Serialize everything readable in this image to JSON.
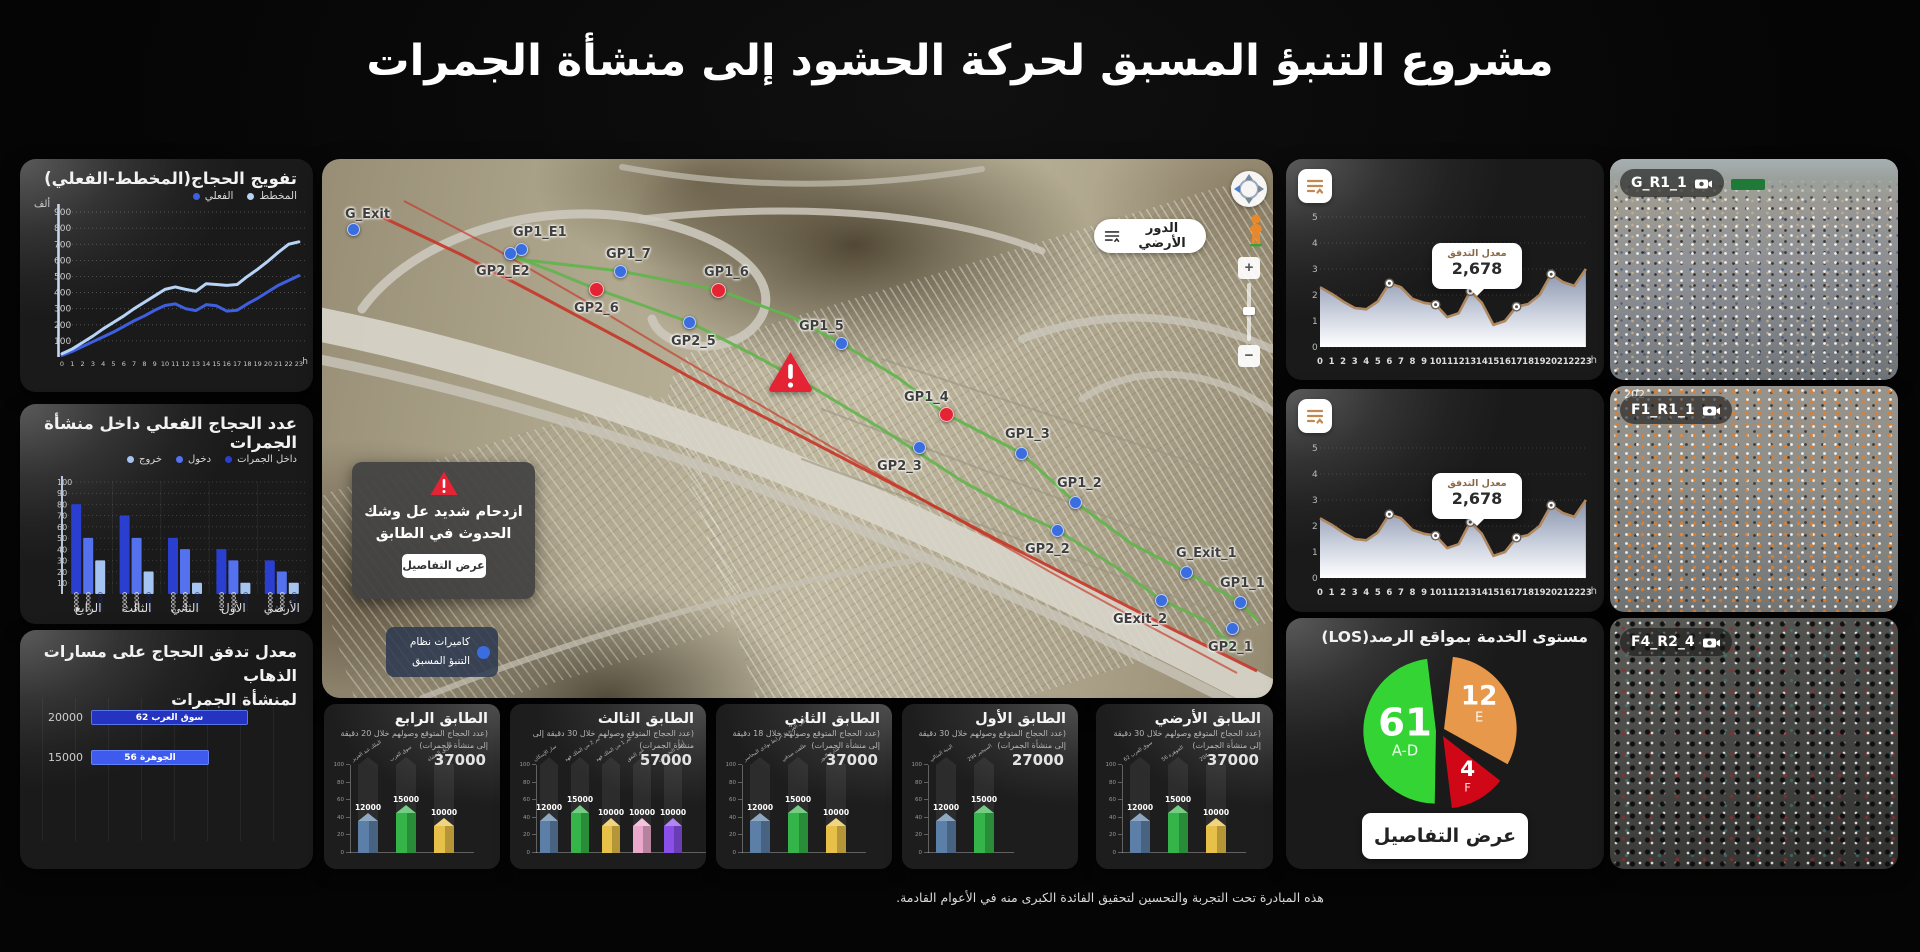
{
  "page": {
    "title": "مشروع التنبؤ المسبق لحركة الحشود إلى منشأة الجمرات",
    "footer": "هذه المبادرة تحت التجربة والتحسين لتحقيق الفائدة الكبرى منه في الأعوام القادمة."
  },
  "chart_data": [
    {
      "id": "tafweej",
      "type": "line",
      "title": "تفويج الحجاج(المخطط-الفعلي)",
      "unit_label": "ألف",
      "x_unit": "h",
      "x": [
        0,
        1,
        2,
        3,
        4,
        5,
        6,
        7,
        8,
        9,
        10,
        11,
        12,
        13,
        14,
        15,
        16,
        17,
        18,
        19,
        20,
        21,
        22,
        23
      ],
      "ylim": [
        0,
        950
      ],
      "yticks": [
        100,
        200,
        300,
        400,
        500,
        600,
        700,
        800,
        900
      ],
      "series": [
        {
          "name": "المخطط",
          "color": "#b7d3f5",
          "values": [
            20,
            50,
            90,
            130,
            175,
            215,
            255,
            300,
            340,
            380,
            420,
            435,
            420,
            408,
            455,
            450,
            445,
            450,
            500,
            545,
            595,
            650,
            700,
            715
          ]
        },
        {
          "name": "الفعلي",
          "color": "#3d5fe0",
          "values": [
            10,
            35,
            65,
            95,
            125,
            155,
            190,
            225,
            255,
            290,
            320,
            330,
            300,
            288,
            325,
            318,
            285,
            290,
            330,
            365,
            405,
            445,
            475,
            505
          ]
        }
      ]
    },
    {
      "id": "inside",
      "type": "bar",
      "title": "عدد الحجاج الفعلي داخل منشأة الجمرات",
      "categories": [
        "الرابع",
        "الثالث",
        "الثاني",
        "الأول",
        "الأرضي"
      ],
      "ylim": [
        0,
        100
      ],
      "yticks": [
        10,
        20,
        30,
        40,
        50,
        60,
        70,
        80,
        90,
        100
      ],
      "unit_scale": 1000,
      "series": [
        {
          "name": "داخل الجمرات",
          "color": "#2a3fd0",
          "values": [
            80000,
            70000,
            50000,
            40000,
            30000
          ]
        },
        {
          "name": "دخول",
          "color": "#5472f0",
          "values": [
            50000,
            50000,
            40000,
            30000,
            20000
          ]
        },
        {
          "name": "خروج",
          "color": "#a6c4f2",
          "values": [
            30000,
            20000,
            10000,
            10000,
            10000
          ]
        }
      ]
    },
    {
      "id": "flow_paths",
      "type": "bar-horizontal",
      "title_line1": "معدل تدفق الحجاج على مسارات الذهاب",
      "title_line2": "لمنشأة الجمرات",
      "xmax": 24000,
      "bars": [
        {
          "label": "سوق العرب 62",
          "value": 20000,
          "value_text": "20000",
          "color": "#2434c0"
        },
        {
          "label": "الجوهرة 56",
          "value": 15000,
          "value_text": "15000",
          "color": "#3f5bee"
        }
      ]
    },
    {
      "id": "floors",
      "type": "bar-group",
      "ylim": [
        0,
        100
      ],
      "yticks": [
        0,
        20,
        40,
        60,
        80,
        100
      ],
      "panels": [
        {
          "title": "الطابق الرابع",
          "subtitle": "(عدد الحجاج المتوقع وصولهم خلال 20 دقيقة إلى منشأة الجمرات)",
          "total": "37000",
          "bars": [
            {
              "label": "الملك عبد العزيز",
              "value": 12000,
              "color": "#5b7fa6"
            },
            {
              "label": "سوق العرب",
              "value": 15000,
              "color": "#35b44a"
            },
            {
              "label": "طريق المشاة",
              "value": 10000,
              "color": "#e7c04a"
            }
          ]
        },
        {
          "title": "الطابق الثالث",
          "subtitle": "(عدد الحجاج المتوقع وصولهم خلال 30 دقيقة إلى منشأة الجمرات)",
          "total": "57000",
          "bars": [
            {
              "label": "سار الإسكان",
              "value": 12000,
              "color": "#5b7fa6"
            },
            {
              "label": "بير 2 من الملك فهد",
              "value": 15000,
              "color": "#35b44a"
            },
            {
              "label": "بير 1 من الملك فهد",
              "value": 10000,
              "color": "#e7c04a"
            },
            {
              "label": "عبر النفق",
              "value": 10000,
              "color": "#eaa8cc"
            },
            {
              "label": "أعلى التخصيص",
              "value": 10000,
              "color": "#8a4fe8"
            }
          ]
        },
        {
          "title": "الطابق الثاني",
          "subtitle": "(عدد الحجاج المتوقع وصولهم خلال 18 دقيقة إلى منشأة الجمرات)",
          "total": "37000",
          "bars": [
            {
              "label": "أعلى العزيزية الرابط بوادي المحاسر",
              "value": 12000,
              "color": "#5b7fa6"
            },
            {
              "label": "طلعت صدقي",
              "value": 15000,
              "color": "#35b44a"
            },
            {
              "label": "شارع النور",
              "value": 10000,
              "color": "#e7c04a"
            }
          ]
        },
        {
          "title": "الطابق الأول",
          "subtitle": "(عدد الحجاج المتوقع وصولهم خلال 30 دقيقة إلى منشأة الجمرات)",
          "total": "27000",
          "bars": [
            {
              "label": "البنية المثالي",
              "value": 12000,
              "color": "#5b7fa6"
            },
            {
              "label": "السيجير 294",
              "value": 15000,
              "color": "#35b44a"
            }
          ]
        },
        {
          "title": "الطابق الأرضي",
          "subtitle": "(عدد الحجاج المتوقع وصولهم خلال 30 دقيقة إلى منشأة الجمرات)",
          "total": "37000",
          "bars": [
            {
              "label": "سوق العرب 62",
              "value": 12000,
              "color": "#5b7fa6"
            },
            {
              "label": "الجوهرة 56",
              "value": 15000,
              "color": "#35b44a"
            },
            {
              "label": "204",
              "value": 10000,
              "color": "#e7c04a"
            }
          ]
        }
      ]
    },
    {
      "id": "flow_rate",
      "type": "area-line",
      "count": 2,
      "x_unit": "h",
      "ylim": [
        0,
        5
      ],
      "yticks": [
        0,
        1,
        2,
        3,
        4,
        5
      ],
      "x": [
        0,
        1,
        2,
        3,
        4,
        5,
        6,
        7,
        8,
        9,
        10,
        11,
        12,
        13,
        14,
        15,
        16,
        17,
        18,
        19,
        20,
        21,
        22,
        23
      ],
      "values": [
        2.3,
        2.05,
        1.75,
        1.5,
        1.45,
        1.75,
        2.45,
        2.3,
        1.85,
        1.7,
        1.63,
        1.15,
        1.3,
        2.15,
        1.7,
        0.85,
        1.0,
        1.55,
        1.65,
        2.0,
        2.8,
        2.5,
        2.35,
        3.0
      ],
      "marker_hours": [
        6,
        10,
        13,
        17,
        20
      ],
      "line_color": "#b08860",
      "tooltip": {
        "label": "معدل التدفق",
        "value": "2,678",
        "at_hour": 13.5
      }
    },
    {
      "id": "los",
      "type": "pie",
      "title": "مستوى الخدمة بمواقع الرصد(LOS)",
      "button": "عرض التفاصيل",
      "slices": [
        {
          "label": "A-D",
          "value": 61,
          "color": "#35d435",
          "start": 181,
          "end": 353,
          "dx": -3,
          "dy": 0
        },
        {
          "label": "E",
          "value": 12,
          "color": "#e8984a",
          "start": 7,
          "end": 119,
          "dx": 5,
          "dy": -2
        },
        {
          "label": "F",
          "value": 4,
          "color": "#cf0716",
          "start": 128,
          "end": 173,
          "dx": 4,
          "dy": 5
        }
      ]
    }
  ],
  "map": {
    "floor_button": "الدور الأرضي",
    "alert": {
      "line1": "ازدحام شديد عل وشك",
      "line2": "الحدوث في الطابق",
      "button": "عرض التفاصيل"
    },
    "legend": {
      "line1": "كاميرات نظام",
      "line2": "التنبؤ المسبق"
    },
    "nav": {
      "zoom_in": "+",
      "zoom_out": "−"
    },
    "markers": [
      {
        "label": "G_Exit",
        "x": 31,
        "y": 70,
        "color": "blue",
        "lx": -8,
        "ly": -22
      },
      {
        "label": "GP1_E1",
        "x": 199,
        "y": 90,
        "color": "blue",
        "lx": -8,
        "ly": -24
      },
      {
        "label": "GP2_E2",
        "x": 188,
        "y": 94,
        "color": "blue",
        "lx": -34,
        "ly": 11
      },
      {
        "label": "GP1_7",
        "x": 298,
        "y": 112,
        "color": "blue",
        "lx": -14,
        "ly": -24
      },
      {
        "label": "GP2_6",
        "x": 274,
        "y": 130,
        "color": "red",
        "lx": -22,
        "ly": 12
      },
      {
        "label": "GP1_6",
        "x": 396,
        "y": 131,
        "color": "red",
        "lx": -14,
        "ly": -25
      },
      {
        "label": "GP2_5",
        "x": 367,
        "y": 163,
        "color": "blue",
        "lx": -18,
        "ly": 12
      },
      {
        "label": "GP1_5",
        "x": 519,
        "y": 184,
        "color": "blue",
        "lx": -42,
        "ly": -24
      },
      {
        "label": "GP1_4",
        "x": 624,
        "y": 255,
        "color": "red",
        "lx": -42,
        "ly": -24
      },
      {
        "label": "GP2_3",
        "x": 597,
        "y": 288,
        "color": "blue",
        "lx": -42,
        "ly": 12
      },
      {
        "label": "GP1_3",
        "x": 699,
        "y": 294,
        "color": "blue",
        "lx": -16,
        "ly": -26
      },
      {
        "label": "GP1_2",
        "x": 753,
        "y": 343,
        "color": "blue",
        "lx": -18,
        "ly": -26
      },
      {
        "label": "GP2_2",
        "x": 735,
        "y": 371,
        "color": "blue",
        "lx": -32,
        "ly": 12
      },
      {
        "label": "G_Exit_1",
        "x": 864,
        "y": 413,
        "color": "blue",
        "lx": -10,
        "ly": -26
      },
      {
        "label": "GExit_2",
        "x": 839,
        "y": 441,
        "color": "blue",
        "lx": -48,
        "ly": 12
      },
      {
        "label": "GP1_1",
        "x": 918,
        "y": 443,
        "color": "blue",
        "lx": -20,
        "ly": -26
      },
      {
        "label": "GP2_1",
        "x": 910,
        "y": 469,
        "color": "blue",
        "lx": -24,
        "ly": 12
      }
    ]
  },
  "cameras": [
    {
      "label": "G_R1_1",
      "overlay": ""
    },
    {
      "label": "F1_R1_1",
      "overlay": "202"
    },
    {
      "label": "F4_R2_4",
      "overlay": ""
    }
  ]
}
